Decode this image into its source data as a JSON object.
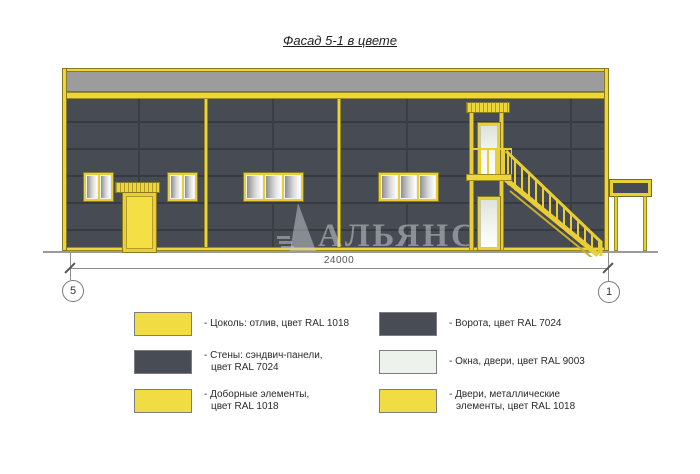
{
  "title": "Фасад 5-1 в цвете",
  "watermark": {
    "text": "АЛЬЯНС",
    "logo": "sail-triangle-logo"
  },
  "drawing": {
    "dimension_total": "24000",
    "grid_axis_left": "5",
    "grid_axis_right": "1"
  },
  "colors": {
    "ral_1018_yellow": "#EED53A",
    "ral_7024_dark": "#474B53",
    "ral_9003_white": "#EDF2ED",
    "parapet_gray": "#9C9C9C"
  },
  "legend": {
    "columns": [
      {
        "items": [
          {
            "color": "#F2DC43",
            "lines": [
              "- Цоколь: отлив, цвет RAL 1018"
            ]
          },
          {
            "color": "#474C55",
            "lines": [
              "- Стены: сэндвич-панели,",
              "цвет RAL 7024"
            ]
          },
          {
            "color": "#F2DC43",
            "lines": [
              "- Доборные элементы,",
              "цвет RAL 1018"
            ]
          }
        ]
      },
      {
        "items": [
          {
            "color": "#474C55",
            "lines": [
              "- Ворота, цвет RAL 7024"
            ]
          },
          {
            "color": "#EDF2ED",
            "lines": [
              "- Окна, двери, цвет RAL 9003"
            ]
          },
          {
            "color": "#F2DC43",
            "lines": [
              "- Двери, металлические",
              "элементы, цвет RAL 1018"
            ]
          }
        ]
      }
    ]
  }
}
